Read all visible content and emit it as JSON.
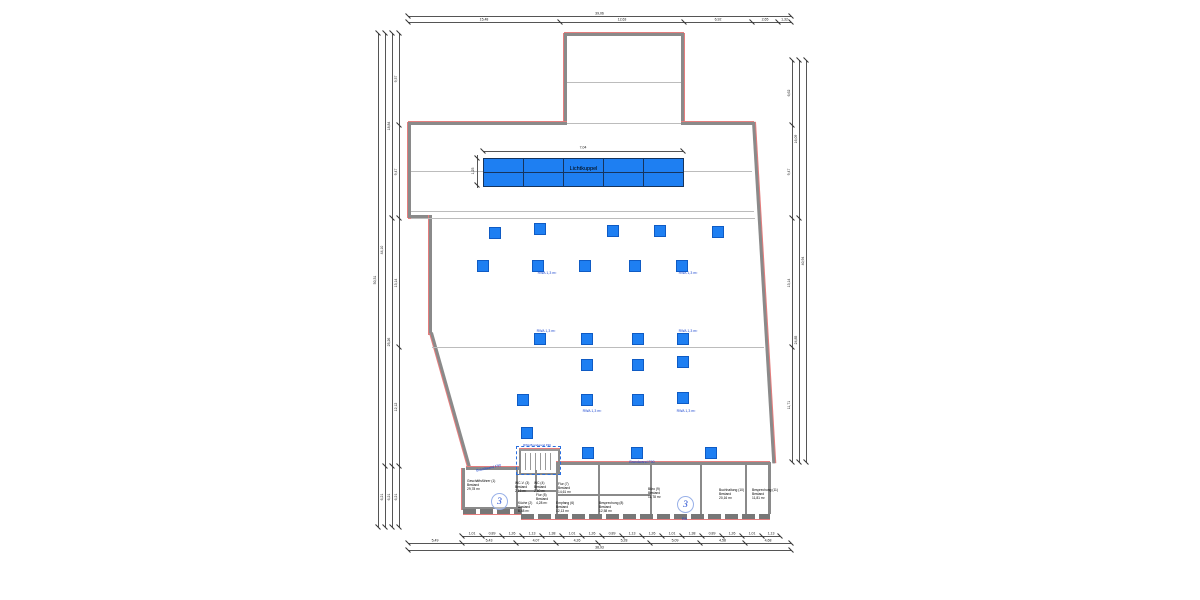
{
  "colors": {
    "vent_blue": "#1e7ff2",
    "label_blue": "#1b46cf",
    "wall_gray": "#8a8a8a",
    "wall_red": "#e57d7d"
  },
  "lichtkuppel": {
    "label": "Lichtkuppel",
    "width_dim": "7,04",
    "height_dim": "1,25"
  },
  "brandwand": {
    "label": "Brandwand F90",
    "stair_label": "RWA Brandwand F90"
  },
  "ra_label": "RA",
  "rwa": {
    "label": "RWA 1,3 m²",
    "squares": [
      [
        495,
        233
      ],
      [
        540,
        229
      ],
      [
        613,
        231
      ],
      [
        660,
        231
      ],
      [
        718,
        232
      ],
      [
        483,
        266
      ],
      [
        538,
        266
      ],
      [
        585,
        266
      ],
      [
        635,
        266
      ],
      [
        682,
        266
      ],
      [
        540,
        339
      ],
      [
        587,
        339
      ],
      [
        638,
        339
      ],
      [
        683,
        339
      ],
      [
        587,
        365
      ],
      [
        638,
        365
      ],
      [
        683,
        362
      ],
      [
        523,
        400
      ],
      [
        587,
        400
      ],
      [
        638,
        400
      ],
      [
        683,
        398
      ],
      [
        527,
        433
      ],
      [
        588,
        453
      ],
      [
        637,
        453
      ],
      [
        711,
        453
      ]
    ],
    "labels": [
      [
        547,
        273
      ],
      [
        688,
        273
      ],
      [
        546,
        331
      ],
      [
        688,
        331
      ],
      [
        592,
        411
      ],
      [
        686,
        411
      ]
    ]
  },
  "circles": [
    {
      "x": 499,
      "y": 501,
      "label": "3"
    },
    {
      "x": 685,
      "y": 504,
      "label": "3"
    }
  ],
  "rooms": [
    {
      "name": "Geschäftsführer (1)",
      "line2": "Bestand",
      "area": "29,78 m²",
      "x": 467,
      "y": 479
    },
    {
      "name": "WC-V. (3)",
      "line2": "Bestand",
      "area": "2,16 m²",
      "x": 515,
      "y": 481
    },
    {
      "name": "WC (4)",
      "line2": "Bestand",
      "area": "2,60 m²",
      "x": 534,
      "y": 481
    },
    {
      "name": "Küche (2)",
      "line2": "Bestand",
      "area": "6,48 m²",
      "x": 518,
      "y": 501
    },
    {
      "name": "Flur (5)",
      "line2": "Bestand",
      "area": "4,28 m²",
      "x": 536,
      "y": 493
    },
    {
      "name": "Flur (7)",
      "line2": "Bestand",
      "area": "14,61 m²",
      "x": 558,
      "y": 482
    },
    {
      "name": "Empfang (6)",
      "line2": "Bestand",
      "area": "12,13 m²",
      "x": 556,
      "y": 501
    },
    {
      "name": "Besprechung (8)",
      "line2": "Bestand",
      "area": "12,58 m²",
      "x": 599,
      "y": 501
    },
    {
      "name": "Büro (9)",
      "line2": "Bestand",
      "area": "11,78 m²",
      "x": 648,
      "y": 487
    },
    {
      "name": "Buchhaltung (10)",
      "line2": "Bestand",
      "area": "20,16 m²",
      "x": 719,
      "y": 488
    },
    {
      "name": "Besprechung (11)",
      "line2": "Bestand",
      "area": "11,81 m²",
      "x": 752,
      "y": 488
    }
  ],
  "dims": {
    "top_total": {
      "o": "h",
      "a": 16,
      "from": 408,
      "to": 791,
      "segs": [
        {
          "end": 791,
          "label": "39,06"
        }
      ]
    },
    "top_segments": {
      "o": "h",
      "a": 22,
      "from": 408,
      "to": 791,
      "segs": [
        {
          "end": 560,
          "label": "15,48"
        },
        {
          "end": 684,
          "label": "12,63"
        },
        {
          "end": 752,
          "label": "6,92"
        },
        {
          "end": 778,
          "label": "2,65"
        },
        {
          "end": 791,
          "label": "1,32"
        }
      ]
    },
    "bottom_windows": {
      "o": "h",
      "a": 536,
      "from": 462,
      "to": 780,
      "segs": [
        {
          "end": 482,
          "label": "1,01"
        },
        {
          "end": 502,
          "label": "0,89"
        },
        {
          "end": 522,
          "label": "1,26"
        },
        {
          "end": 542,
          "label": "1,13"
        },
        {
          "end": 562,
          "label": "1,38"
        },
        {
          "end": 582,
          "label": "1,01"
        },
        {
          "end": 602,
          "label": "1,26"
        },
        {
          "end": 622,
          "label": "0,89"
        },
        {
          "end": 642,
          "label": "1,13"
        },
        {
          "end": 662,
          "label": "1,26"
        },
        {
          "end": 682,
          "label": "1,01"
        },
        {
          "end": 702,
          "label": "1,38"
        },
        {
          "end": 722,
          "label": "0,89"
        },
        {
          "end": 742,
          "label": "1,26"
        },
        {
          "end": 762,
          "label": "1,01"
        },
        {
          "end": 780,
          "label": "1,13"
        }
      ]
    },
    "bottom_rooms": {
      "o": "h",
      "a": 543,
      "from": 408,
      "to": 791,
      "segs": [
        {
          "end": 462,
          "label": "5,49"
        },
        {
          "end": 516,
          "label": "5,43"
        },
        {
          "end": 556,
          "label": "4,07"
        },
        {
          "end": 598,
          "label": "4,26"
        },
        {
          "end": 650,
          "label": "5,28"
        },
        {
          "end": 700,
          "label": "5,09"
        },
        {
          "end": 745,
          "label": "4,58"
        },
        {
          "end": 791,
          "label": "4,68"
        }
      ]
    },
    "bottom_total": {
      "o": "h",
      "a": 550,
      "from": 408,
      "to": 791,
      "segs": [
        {
          "end": 791,
          "label": "38,93"
        }
      ]
    },
    "left_1": {
      "o": "v",
      "a": 399,
      "from": 33,
      "to": 527,
      "segs": [
        {
          "end": 125,
          "label": "9,37"
        },
        {
          "end": 218,
          "label": "9,47"
        },
        {
          "end": 347,
          "label": "13,14"
        },
        {
          "end": 466,
          "label": "12,12"
        },
        {
          "end": 527,
          "label": "6,21"
        }
      ]
    },
    "left_2": {
      "o": "v",
      "a": 392,
      "from": 33,
      "to": 527,
      "segs": [
        {
          "end": 218,
          "label": "18,84"
        },
        {
          "end": 466,
          "label": "25,26"
        },
        {
          "end": 527,
          "label": "6,21"
        }
      ]
    },
    "left_3": {
      "o": "v",
      "a": 385,
      "from": 33,
      "to": 527,
      "segs": [
        {
          "end": 466,
          "label": "44,10"
        },
        {
          "end": 527,
          "label": "6,21"
        }
      ]
    },
    "left_4": {
      "o": "v",
      "a": 378,
      "from": 33,
      "to": 527,
      "segs": [
        {
          "end": 527,
          "label": "50,31"
        }
      ]
    },
    "right_1": {
      "o": "v",
      "a": 792,
      "from": 60,
      "to": 462,
      "segs": [
        {
          "end": 125,
          "label": "6,62"
        },
        {
          "end": 218,
          "label": "9,47"
        },
        {
          "end": 347,
          "label": "13,14"
        },
        {
          "end": 462,
          "label": "11,71"
        }
      ]
    },
    "right_2": {
      "o": "v",
      "a": 799,
      "from": 60,
      "to": 462,
      "segs": [
        {
          "end": 218,
          "label": "16,09"
        },
        {
          "end": 462,
          "label": "24,85"
        }
      ]
    },
    "right_3": {
      "o": "v",
      "a": 806,
      "from": 60,
      "to": 462,
      "segs": [
        {
          "end": 462,
          "label": "40,94"
        }
      ]
    }
  }
}
